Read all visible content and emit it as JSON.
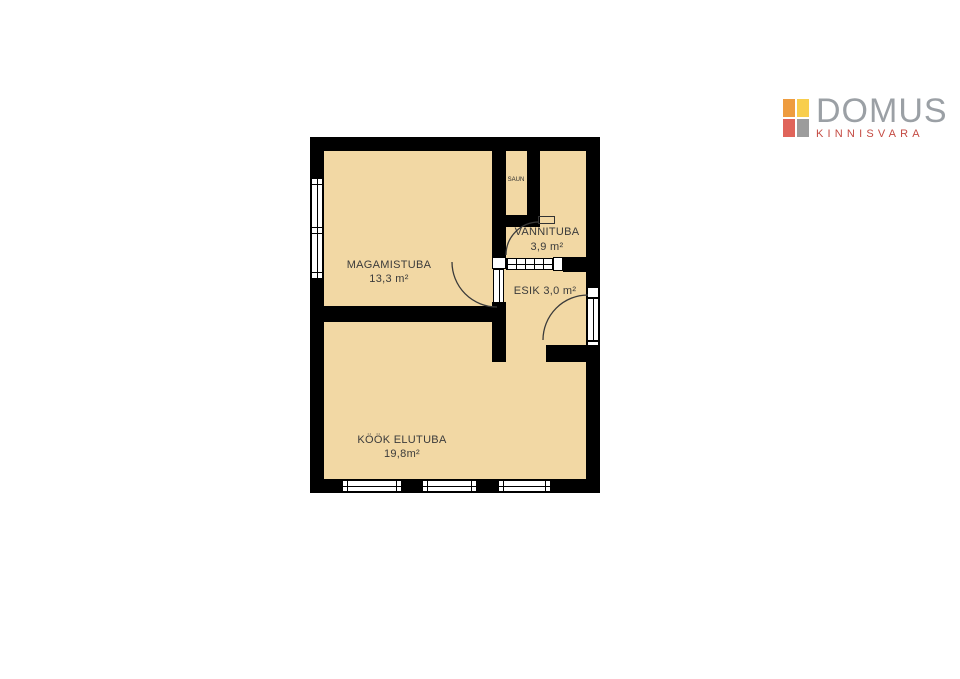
{
  "logo": {
    "brand": "DOMUS",
    "tagline": "KINNISVARA",
    "brand_color": "#9BA0A5",
    "tagline_color": "#C44A42",
    "icon": {
      "name": "domus-grid-icon",
      "top_left_color": "#EE9C3F",
      "top_right_color": "#F8CE4D",
      "bottom_left_color": "#E0645A",
      "bottom_right_color": "#9C9C9C"
    }
  },
  "floor_plan": {
    "wall_color": "#000000",
    "floor_color": "#F2D8A4",
    "rooms": [
      {
        "id": "magamistuba",
        "name": "MAGAMISTUBA",
        "area": "13,3 m²"
      },
      {
        "id": "kook-elutuba",
        "name": "KÖÖK ELUTUBA",
        "area": "19,8m²"
      },
      {
        "id": "vannituba",
        "name": "VANNITUBA",
        "area": "3,9 m²"
      },
      {
        "id": "esik",
        "name": "ESIK",
        "area": "3,0 m²"
      },
      {
        "id": "saun",
        "name": "SAUN"
      }
    ]
  }
}
